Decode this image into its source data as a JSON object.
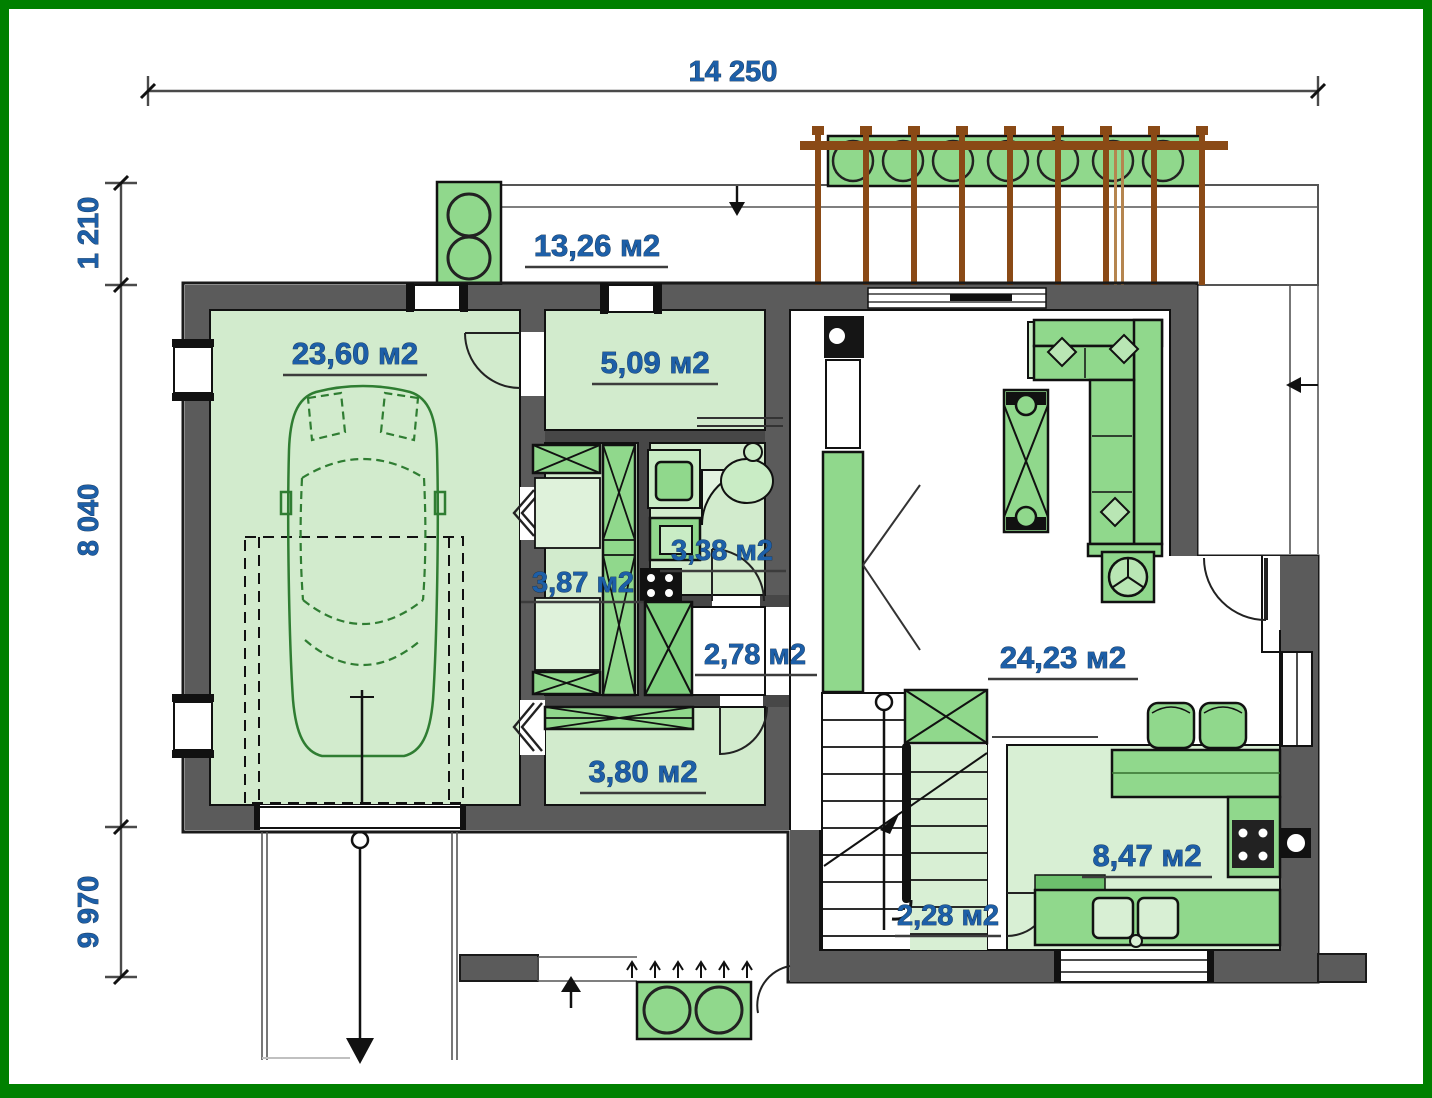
{
  "plan": {
    "dimensions": {
      "width_top": "14 250",
      "left_top": "1 210",
      "left_middle": "8 040",
      "left_bottom": "9 970"
    },
    "areas": {
      "terrace": "13,26 м2",
      "garage": "23,60 м2",
      "pantry": "5,09 м2",
      "closet": "3,87 м2",
      "bathroom": "3,38 м2",
      "hall": "2,78 м2",
      "living_room": "24,23 м2",
      "mudroom": "3,80 м2",
      "kitchen": "8,47 м2",
      "stair_lobby": "2,28 м2"
    },
    "colors": {
      "frame": "#008000",
      "walls": "#5b5b5b",
      "floor_light_green": "#d2ebcd",
      "furniture_green": "#90d88c",
      "label_blue": "#1d5fa8",
      "pergola_brown": "#8a4a16"
    }
  }
}
